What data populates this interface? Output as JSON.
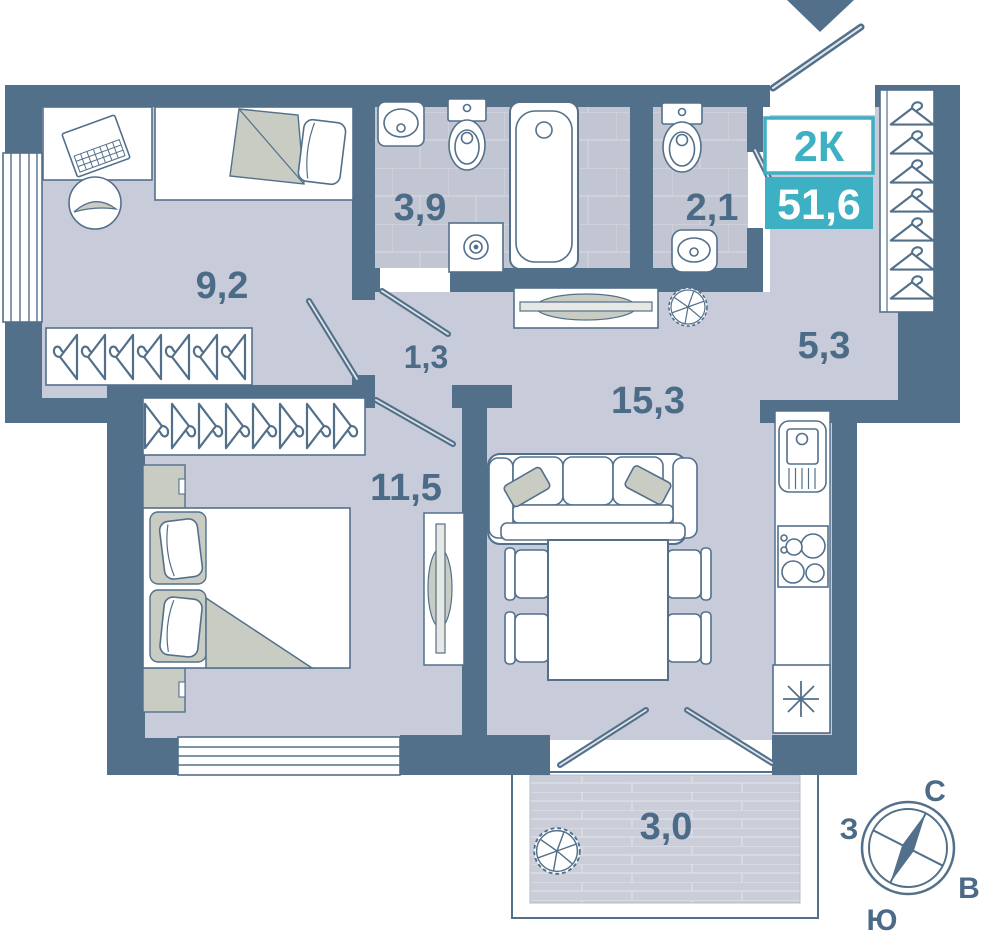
{
  "plan": {
    "badge": {
      "type_label": "2К",
      "area_value": "51,6"
    },
    "rooms": {
      "bedroom_small": "9,2",
      "bathroom": "3,9",
      "wc": "2,1",
      "hallway": "5,3",
      "corridor": "1,3",
      "living_kitchen": "15,3",
      "bedroom_main": "11,5",
      "balcony": "3,0"
    },
    "compass": {
      "north": "С",
      "west": "З",
      "east": "В",
      "south": "Ю"
    },
    "colors": {
      "wall": "#53708b",
      "floor": "#c8cbd9",
      "tile_floor": "#c2c6d2",
      "accent_teal": "#3eb0c3",
      "label_text": "#4b6b87",
      "furniture_gray": "#c8ccc3"
    },
    "icons": [
      "entrance-arrow-icon",
      "door-swing-icon",
      "window-icon",
      "hanger-icon",
      "single-bed-icon",
      "double-bed-icon",
      "desk-laptop-icon",
      "office-chair-icon",
      "sofa-icon",
      "dining-table-icon",
      "dining-chair-icon",
      "tv-icon",
      "nightstand-icon",
      "wash-basin-icon",
      "toilet-icon",
      "bathtub-icon",
      "washing-machine-icon",
      "kitchen-sink-icon",
      "stove-icon",
      "fridge-icon",
      "plant-icon",
      "console-bench-icon",
      "compass-icon"
    ]
  }
}
